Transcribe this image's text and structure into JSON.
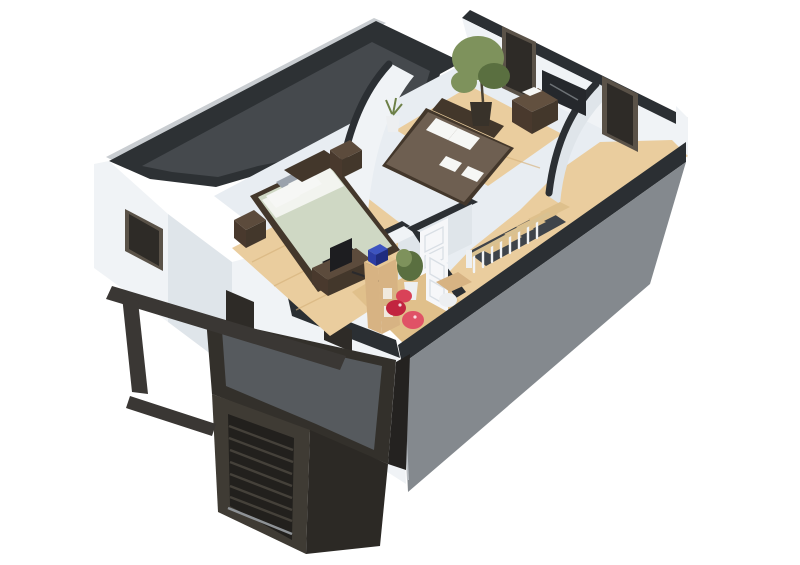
{
  "meta": {
    "title": "3D cutaway floor plan render - upper floor with two bedrooms, landing, garage and carport",
    "render_type": "isometric architectural visualization",
    "visible_text": ""
  },
  "palette": {
    "bg": "#ffffff",
    "wall_top_light": "#c9cdd1",
    "roof_edge": "#2d3134",
    "roof_surface": "#45494d",
    "wall_white": "#f0f3f6",
    "wall_white_shade": "#dfe5ea",
    "interior_wall": "#e8edf2",
    "cut_charcoal": "#2b2f33",
    "gray_wall": "#84898e",
    "window_dark": "#2e2b27",
    "window_frame": "#5a5248",
    "floor_wood": "#eacd9e",
    "floor_wood_shade": "#e0c08b",
    "plank": "#d6b27c",
    "garage_rim": "#33302b",
    "garage_roof": "#565a5e",
    "garage_wall": "#3f3b34",
    "garage_wall_dark": "#2c2925",
    "garage_door": "#22201d",
    "garage_slat": "#45413a",
    "carport": "#3a3734",
    "corner_shadow": "#242220",
    "bed1_duvet": "#cfd8c4",
    "bed1_sheet": "#f2f4ef",
    "pillow_white": "#f6f7f5",
    "cushion_gray": "#9aa2ac",
    "bed_frame_dark": "#43372b",
    "nightstand": "#5c4b3c",
    "nightstand_dark": "#49392d",
    "tv_dark": "#1d1d20",
    "bed2_duvet": "#6e5f51",
    "dresser": "#62503f",
    "plant_green": "#7e925c",
    "plant_green_dark": "#5a6f40",
    "pot_dark": "#38322a",
    "pot_white": "#edeff1",
    "desk_wood": "#d7b383",
    "desk_wood_light": "#e6c896",
    "blue_item": "#2c3da4",
    "blue_item_dark": "#1f2c7e",
    "red_a": "#c2243f",
    "red_b": "#e05266",
    "stair_wood": "#dec08c",
    "stair_rail": "#d9c191",
    "baluster": "#f2f4f6",
    "door_white": "#f6f7f9",
    "door_shade": "#d9dfe5",
    "art_dark": "#25282c"
  },
  "scene": {
    "exterior": {
      "roof": "flat charcoal roof over left wing",
      "walls": "white rendered walls with dark window openings",
      "front_facade": "gray wall with charcoal cut cap",
      "garage": "dark garage volume with horizontal slatted door and gray flat roof",
      "carport": "dark open beam frame with single post at entrance"
    },
    "rooms": [
      {
        "name": "master-bedroom",
        "furniture": [
          "double-bed-sage-duvet",
          "white-pillows",
          "gray-cushions",
          "dark-headboard",
          "nightstand-left",
          "nightstand-right",
          "tv-cabinet",
          "television",
          "dark-foot-throw"
        ]
      },
      {
        "name": "second-bedroom",
        "furniture": [
          "double-bed-brown-duvet",
          "white-pillows",
          "white-towels",
          "tall-potted-plant",
          "small-white-plant",
          "dresser-with-white-box",
          "wall-art",
          "window-left",
          "window-right"
        ]
      },
      {
        "name": "landing-hallway",
        "furniture": [
          "staircase-down",
          "white-balusters",
          "wood-handrail",
          "closed-panel-door",
          "open-panel-door",
          "wood-plank-floor"
        ]
      },
      {
        "name": "small-room",
        "furniture": [
          "wood-shelf-desk",
          "blue-storage-box",
          "potted-plant-white-pot",
          "red-poufs",
          "white-seats",
          "small-wood-table"
        ]
      }
    ]
  }
}
